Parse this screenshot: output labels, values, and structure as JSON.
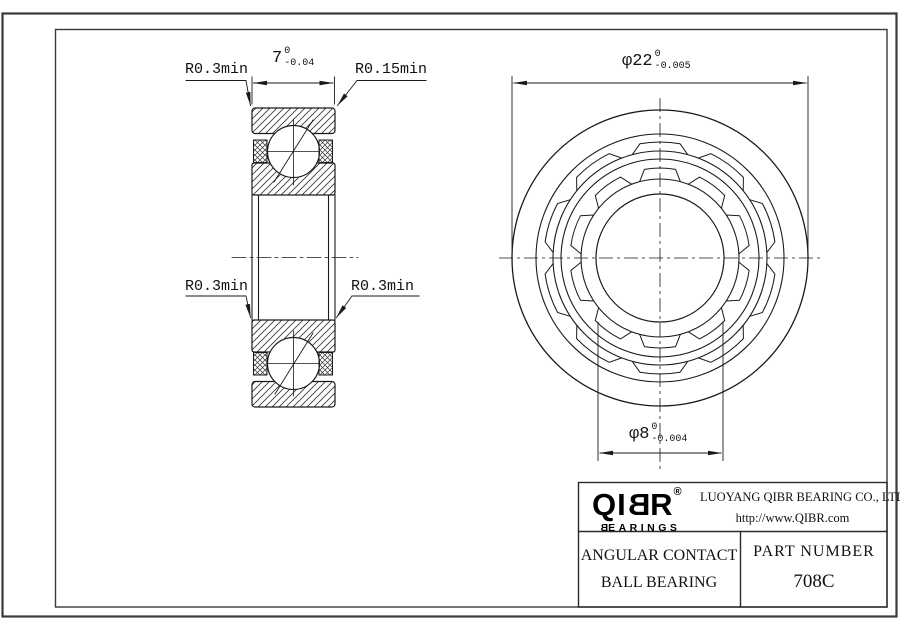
{
  "drawing": {
    "dim_width": {
      "value": "7",
      "tol_upper": "0",
      "tol_lower": "-0.04"
    },
    "dim_outer": {
      "value": "φ22",
      "tol_upper": "0",
      "tol_lower": "-0.005"
    },
    "dim_bore": {
      "value": "φ8",
      "tol_upper": "0",
      "tol_lower": "-0.004"
    },
    "radius_labels": {
      "top_left": "R0.3min",
      "top_right": "R0.15min",
      "mid_left": "R0.3min",
      "mid_right": "R0.3min"
    }
  },
  "title_block": {
    "logo": {
      "pre": "QI",
      "b": "B",
      "post": "R",
      "registered": "®",
      "sub_first": "B",
      "sub_rest": "EARINGS"
    },
    "company": "LUOYANG QIBR BEARING CO., LTD",
    "website": "http://www.QIBR.com",
    "product_line1": "ANGULAR CONTACT",
    "product_line2": "BALL BEARING",
    "part_number_label": "PART NUMBER",
    "part_number": "708C"
  }
}
